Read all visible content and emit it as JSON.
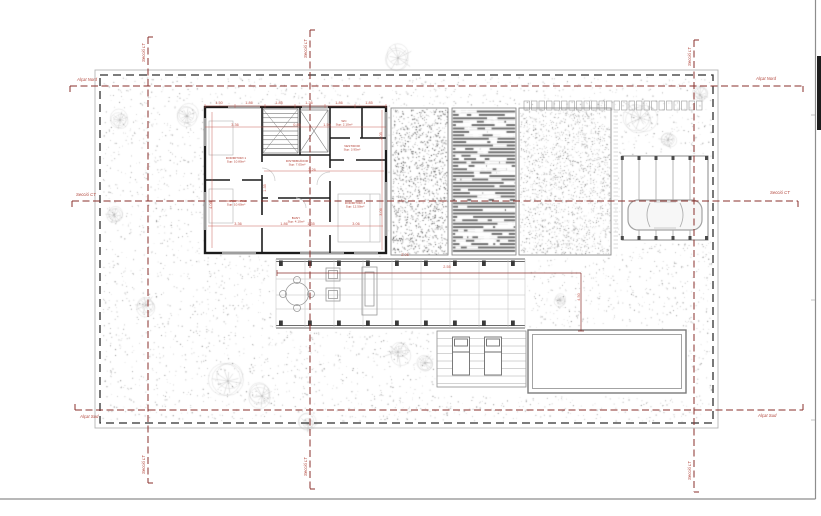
{
  "sheet": {
    "background": "#ffffff",
    "border_color": "#8d8d8d"
  },
  "colors": {
    "section_line_red": "#8a2f2b",
    "annotation_red": "#c2544a",
    "room_label_red": "#b03a2e",
    "wall_black": "#1c1c1c",
    "boundary_dash": "#2f2f2f",
    "texture_gray": "#8f8f8f"
  },
  "section_labels": {
    "north_left": "Alçat Nord",
    "north_right": "Alçat Nord",
    "south_left": "Alçat Sud",
    "south_right": "Alçat Sud",
    "mid_left": "Secció CT",
    "mid_right": "Secció CT"
  },
  "vertical_line_label": "Secció LT",
  "rooms": [
    {
      "name": "DORMITORI 1",
      "area": "Sup: 10.80m²",
      "x": 236,
      "y": 159
    },
    {
      "name": "DORMITORI 2",
      "area": "Sup: 10.60m²",
      "x": 236,
      "y": 202
    },
    {
      "name": "DISTRIBUÏDOR",
      "area": "Sup: 7.05m²",
      "x": 297,
      "y": 162
    },
    {
      "name": "BANY",
      "area": "Sup: 4.10m²",
      "x": 296,
      "y": 219
    },
    {
      "name": "VESTIDOR",
      "area": "Sup: 3.95m²",
      "x": 352,
      "y": 147
    },
    {
      "name": "DORMITORI 3",
      "area": "Sup: 12.50m²",
      "x": 355,
      "y": 204
    },
    {
      "name": "WC",
      "area": "Sup: 2.10m²",
      "x": 344,
      "y": 122
    }
  ],
  "dims": {
    "items": [
      {
        "t": "1.50",
        "x": 219,
        "y": 104
      },
      {
        "t": "1.86",
        "x": 249,
        "y": 104
      },
      {
        "t": "1.85",
        "x": 279,
        "y": 104
      },
      {
        "t": "1.36",
        "x": 309,
        "y": 104
      },
      {
        "t": "1.86",
        "x": 339,
        "y": 104
      },
      {
        "t": "1.85",
        "x": 369,
        "y": 104
      },
      {
        "t": "3.36",
        "x": 235,
        "y": 126
      },
      {
        "t": "0.85",
        "x": 297,
        "y": 126
      },
      {
        "t": "1.50",
        "x": 327,
        "y": 126
      },
      {
        "t": "3.26",
        "x": 312,
        "y": 171
      },
      {
        "t": "3.36",
        "x": 238,
        "y": 225
      },
      {
        "t": "1.86",
        "x": 284,
        "y": 225
      },
      {
        "t": "1.35",
        "x": 311,
        "y": 225
      },
      {
        "t": "3.06",
        "x": 356,
        "y": 225
      },
      {
        "t": "4.06",
        "x": 212,
        "y": 205,
        "r": -90
      },
      {
        "t": "1.35",
        "x": 266,
        "y": 188,
        "r": -90
      },
      {
        "t": "2.05",
        "x": 382,
        "y": 136,
        "r": -90
      },
      {
        "t": "3.06",
        "x": 382,
        "y": 212,
        "r": -90
      },
      {
        "t": "2.05",
        "x": 405,
        "y": 256
      },
      {
        "t": "2.55",
        "x": 447,
        "y": 268
      },
      {
        "t": "4.50",
        "x": 580,
        "y": 297,
        "r": -90
      }
    ]
  },
  "trees": [
    {
      "x": 187,
      "y": 116,
      "r": 9
    },
    {
      "x": 398,
      "y": 58,
      "r": 13
    },
    {
      "x": 640,
      "y": 118,
      "r": 15
    },
    {
      "x": 668,
      "y": 140,
      "r": 8
    },
    {
      "x": 114,
      "y": 215,
      "r": 7
    },
    {
      "x": 146,
      "y": 305,
      "r": 9
    },
    {
      "x": 228,
      "y": 381,
      "r": 15
    },
    {
      "x": 262,
      "y": 396,
      "r": 10
    },
    {
      "x": 308,
      "y": 424,
      "r": 8
    },
    {
      "x": 398,
      "y": 352,
      "r": 11
    },
    {
      "x": 425,
      "y": 363,
      "r": 8
    },
    {
      "x": 660,
      "y": 228,
      "r": 7
    },
    {
      "x": 700,
      "y": 95,
      "r": 7
    },
    {
      "x": 420,
      "y": 152,
      "r": 9
    },
    {
      "x": 428,
      "y": 198,
      "r": 7
    },
    {
      "x": 120,
      "y": 120,
      "r": 8
    },
    {
      "x": 560,
      "y": 300,
      "r": 5
    }
  ]
}
